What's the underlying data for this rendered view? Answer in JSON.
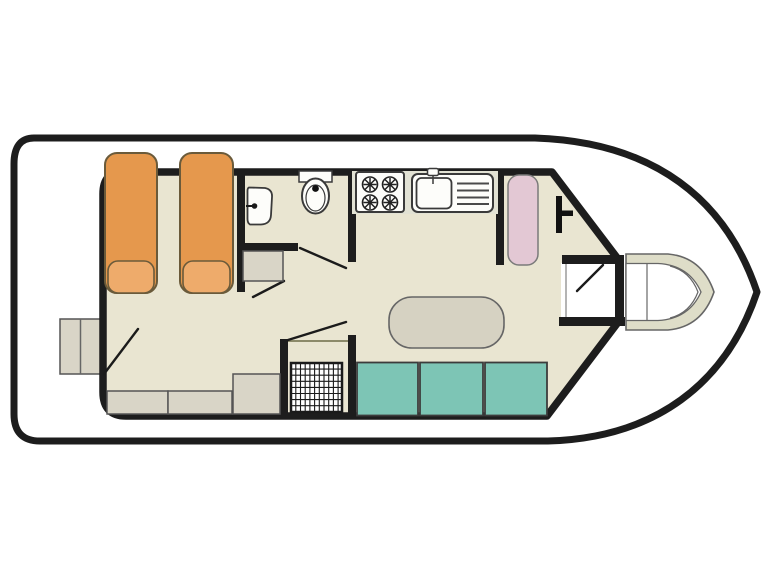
{
  "title": "Houseboat deck plan",
  "diagram": {
    "type": "houseboat-floor-plan",
    "orientation": "bow-right",
    "colors": {
      "hull_outline": "#1d1d1d",
      "deck": "#ffffff",
      "floor": "#e9e5d1",
      "counter_strip": "#e2e2d4",
      "bed": "#e5984d",
      "pillow": "#eeab6b",
      "cabinet": "#d9d5c7",
      "bench": "#7dc5b5",
      "wardrobe": "#e3c8d4",
      "table": "#d6d2c2",
      "bow_seat": "#deddc8",
      "fixture": "#fdfdfa"
    },
    "rooms": [
      "fore-cabin-twin-beds",
      "bathroom",
      "shower-room",
      "galley",
      "saloon-dinette",
      "helm-area",
      "bow-deck",
      "stern-step"
    ],
    "furniture": [
      "single-bed-x2",
      "pillow-x2",
      "washbasin",
      "toilet",
      "hob-4-burner",
      "sink-with-drainer",
      "wardrobe",
      "helm-console",
      "dinette-table",
      "bench-seat-3-section",
      "storage-cabinets",
      "shower-tray-grid",
      "bow-seating",
      "stern-step-box"
    ]
  }
}
